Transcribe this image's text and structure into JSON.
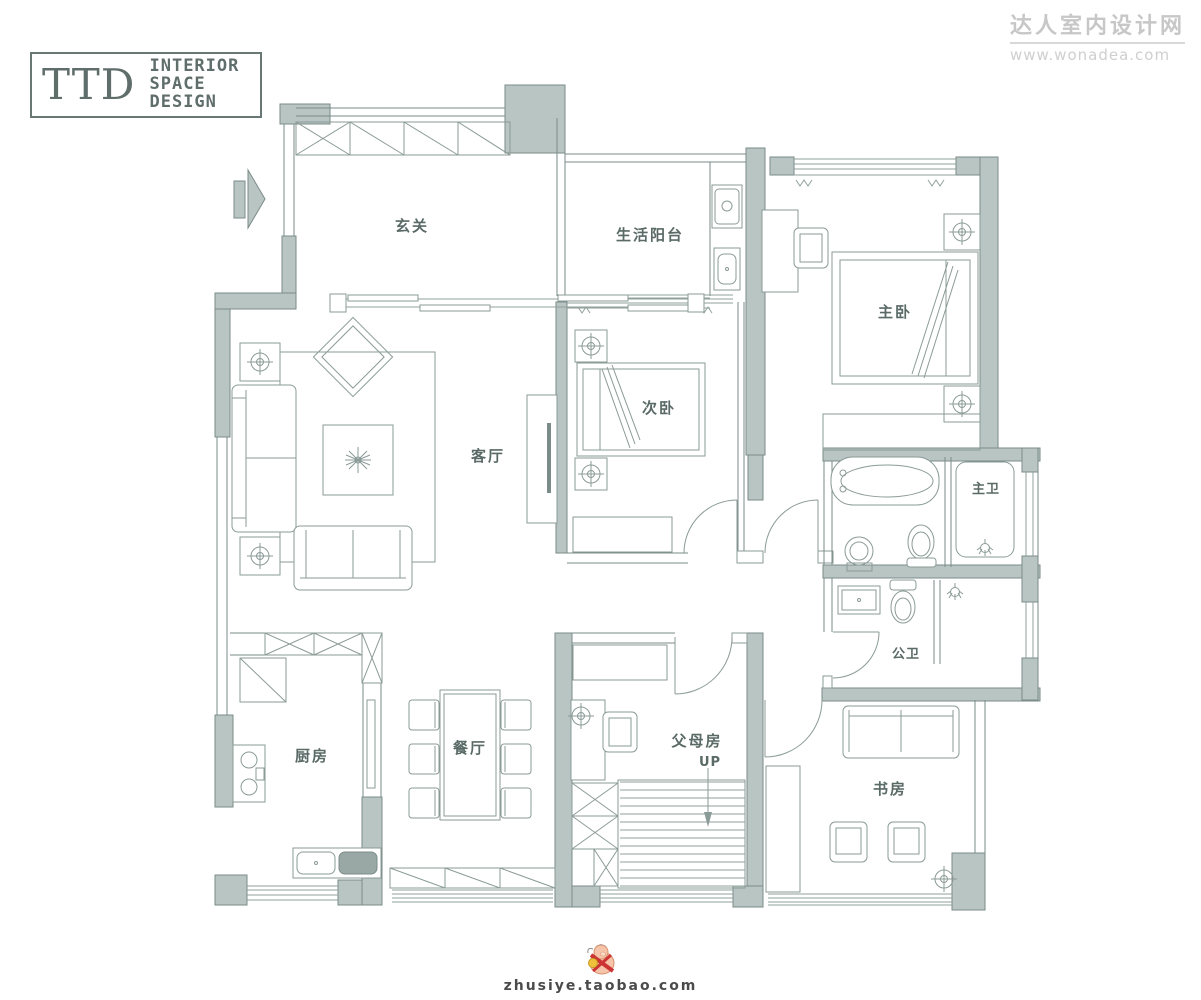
{
  "logo": {
    "ttd": "TTD",
    "line1": "INTERIOR",
    "line2": "SPACE",
    "line3": "DESIGN"
  },
  "site_watermark": {
    "title": "达人室内设计网",
    "url": "www.wonadea.com"
  },
  "footer": {
    "shop": "zhusiye.taobao.com"
  },
  "rooms": {
    "foyer": "玄关",
    "balcony": "生活阳台",
    "master": "主卧",
    "second": "次卧",
    "living": "客厅",
    "master_bath": "主卫",
    "public_bath": "公卫",
    "kitchen": "厨房",
    "dining": "餐厅",
    "parents": "父母房",
    "study": "书房",
    "stairs_up": "UP"
  },
  "colors": {
    "wall_fill": "#b8c5c3",
    "wall_line": "#7b8b88",
    "label": "#5a6a66",
    "watermark": "#c7c7c7"
  }
}
